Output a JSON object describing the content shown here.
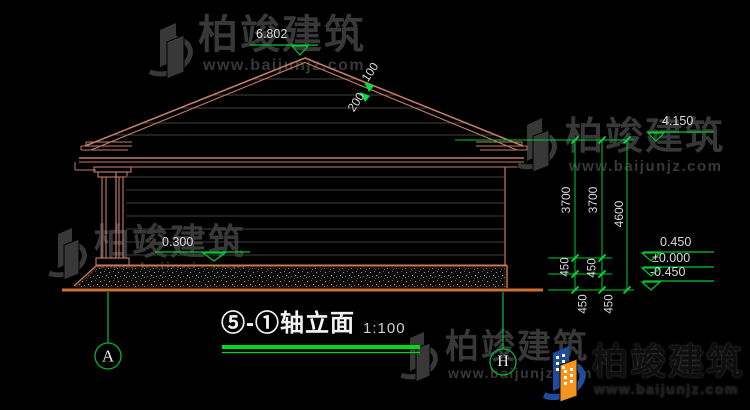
{
  "title": {
    "name": "⑤-①轴立面",
    "scale": "1:100"
  },
  "levels": {
    "ridge": "6.802",
    "eave": "4.150",
    "porch": "0.300",
    "plinth": "0.450",
    "zero": "±0.000",
    "ground": "-0.450"
  },
  "slope": {
    "run": "200",
    "rise": "100"
  },
  "dimensions": {
    "left_chain": [
      "3700",
      "450",
      "450"
    ],
    "mid_chain": [
      "3700",
      "450",
      "450"
    ],
    "total": "4600"
  },
  "axes": {
    "left": "A",
    "right": "H"
  },
  "watermark": {
    "brand": "柏竣建筑",
    "url": "www.baijunjz.com"
  },
  "colors": {
    "wall_line": "#C27B66",
    "ground_line": "#CE6F33",
    "dimension_green": "#00C832",
    "underline_green": "#00DC14",
    "siding_grey": "#3E3E3E",
    "text": "#DADADA",
    "logo_blue": "#1C4E9E",
    "logo_orange": "#F7941D"
  }
}
